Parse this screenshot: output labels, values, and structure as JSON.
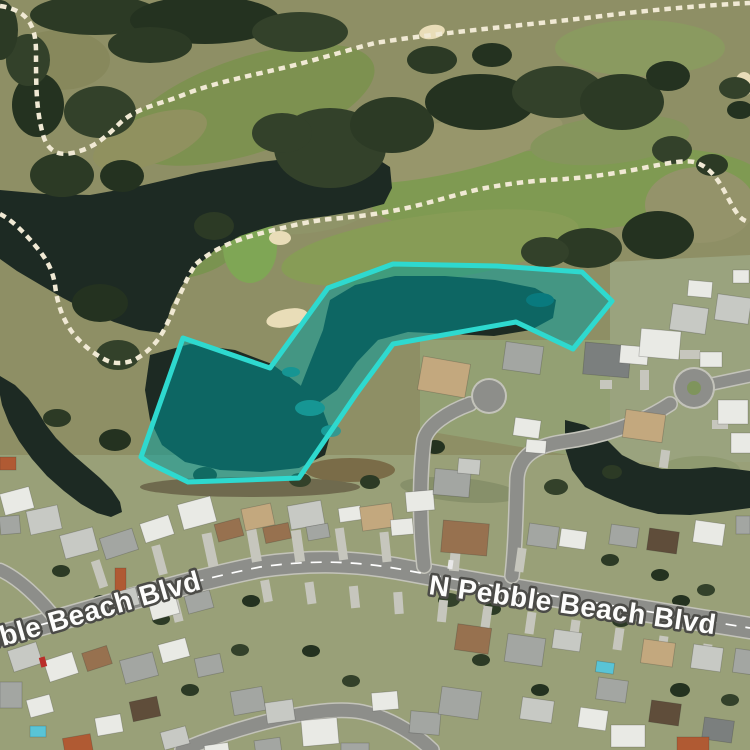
{
  "map": {
    "base_color": "#8e8f65",
    "street_labels": [
      {
        "text": "bble Beach Blvd",
        "x": -14,
        "y": 651,
        "rotation": -16,
        "size": 28
      },
      {
        "text": "N Pebble Beach Blvd",
        "x": 428,
        "y": 594,
        "rotation": 8,
        "size": 28
      }
    ],
    "overlay": {
      "points": "183,338 270,368 328,288 393,264 497,266 582,272 612,301 573,349 516,322 393,344 357,393 299,478 188,482 149,463 141,457",
      "stroke": "#2ed9cf",
      "fill": "rgba(0,158,160,0.52)",
      "stroke_width": 5
    },
    "regions": [
      {
        "pts": "0,455 750,455 750,750 0,750",
        "c": "#99a078"
      },
      {
        "pts": "610,262 750,255 750,462 610,462",
        "c": "#9aa37e"
      },
      {
        "pts": "420,340 610,340 610,462 420,430",
        "c": "#93a073"
      }
    ],
    "patches": [
      [
        250,
        105,
        130,
        48,
        -18,
        "#7d9150"
      ],
      [
        565,
        190,
        195,
        42,
        -4,
        "#7f9a52"
      ],
      [
        430,
        248,
        150,
        33,
        -8,
        "#879c56"
      ],
      [
        183,
        252,
        55,
        26,
        -10,
        "#7a9350"
      ],
      [
        640,
        48,
        85,
        28,
        0,
        "#8a9a60"
      ],
      [
        700,
        205,
        55,
        38,
        0,
        "#94936a"
      ],
      [
        95,
        240,
        65,
        28,
        -15,
        "#8b8c62"
      ],
      [
        445,
        148,
        120,
        26,
        -12,
        "#97966b"
      ],
      [
        300,
        212,
        70,
        22,
        -5,
        "#8f9468"
      ],
      [
        610,
        140,
        80,
        24,
        -6,
        "#85955c"
      ],
      [
        150,
        140,
        60,
        24,
        -20,
        "#90915f"
      ],
      [
        60,
        60,
        50,
        30,
        0,
        "#87885c"
      ],
      [
        250,
        247,
        27,
        36,
        0,
        "#7fa655"
      ],
      [
        350,
        470,
        45,
        12,
        0,
        "#7a6c48"
      ],
      [
        250,
        487,
        110,
        10,
        0,
        "#6f6a4e"
      ],
      [
        460,
        490,
        60,
        12,
        5,
        "#87906a"
      ],
      [
        700,
        470,
        40,
        14,
        0,
        "#8f9a70"
      ]
    ],
    "bunker_color": "#e9ddb8",
    "bunkers": [
      [
        287,
        318,
        21,
        9,
        -12
      ],
      [
        280,
        238,
        11,
        7,
        0
      ],
      [
        744,
        84,
        9,
        12,
        0
      ],
      [
        432,
        32,
        13,
        7,
        -10
      ]
    ],
    "pond_color": "#1d2a23",
    "ponds": [
      {
        "pts": "0,190 45,194 90,195 140,186 200,172 260,162 320,155 365,151 390,167 392,188 384,204 358,211 328,216 298,220 268,227 240,236 215,250 196,267 181,287 171,307 166,324 161,333 139,330 114,322 88,311 63,298 39,284 17,271 0,259"
      },
      {
        "pts": "0,376 15,385 28,398 38,412 46,425 56,438 70,452 85,465 100,478 112,490 120,502 122,512 111,517 97,513 81,504 64,491 47,476 32,459 19,441 9,423 2,405 0,395"
      },
      {
        "pts": "150,355 190,344 235,350 272,364 300,385 322,408 331,432 325,455 299,468 262,472 220,470 185,462 162,445 150,420 145,390"
      },
      {
        "pts": "330,300 355,285 395,276 445,276 495,280 535,288 556,300 553,318 531,330 494,336 450,334 408,332 378,340 357,362 337,390 317,404 300,388 311,360 323,330 327,312"
      },
      {
        "pts": "565,420 585,425 605,438 622,455 640,464 662,469 690,469 715,467 735,469 750,471 750,508 720,512 690,515 658,514 630,507 605,497 585,487 572,470 565,448"
      }
    ],
    "shallows": [
      [
        310,
        408,
        15,
        8,
        "#2f8f88"
      ],
      [
        331,
        431,
        10,
        6,
        "#35978f"
      ],
      [
        291,
        372,
        9,
        5,
        "#2e8c86"
      ],
      [
        540,
        300,
        14,
        7,
        "#14555a"
      ]
    ],
    "tree_colors": [
      "#2c3a25",
      "#243220",
      "#33412a"
    ],
    "trees": [
      [
        95,
        15,
        65,
        20
      ],
      [
        205,
        20,
        75,
        24
      ],
      [
        300,
        32,
        48,
        20
      ],
      [
        150,
        45,
        42,
        18
      ],
      [
        38,
        105,
        26,
        32
      ],
      [
        100,
        112,
        36,
        26
      ],
      [
        62,
        175,
        32,
        22
      ],
      [
        122,
        176,
        22,
        16
      ],
      [
        330,
        148,
        56,
        40
      ],
      [
        392,
        125,
        42,
        28
      ],
      [
        480,
        102,
        55,
        28
      ],
      [
        558,
        92,
        46,
        26
      ],
      [
        622,
        102,
        42,
        28
      ],
      [
        668,
        76,
        22,
        15
      ],
      [
        735,
        88,
        16,
        11
      ],
      [
        588,
        248,
        34,
        20
      ],
      [
        658,
        235,
        36,
        24
      ],
      [
        545,
        252,
        24,
        15
      ],
      [
        214,
        226,
        20,
        14
      ],
      [
        100,
        303,
        28,
        19
      ],
      [
        118,
        355,
        22,
        15
      ],
      [
        57,
        418,
        14,
        9
      ],
      [
        115,
        440,
        16,
        11
      ],
      [
        282,
        133,
        30,
        20
      ],
      [
        432,
        60,
        25,
        14
      ],
      [
        492,
        55,
        20,
        12
      ],
      [
        672,
        150,
        20,
        14
      ],
      [
        712,
        165,
        16,
        11
      ],
      [
        740,
        110,
        13,
        9
      ],
      [
        28,
        60,
        22,
        26
      ],
      [
        0,
        30,
        18,
        30
      ],
      [
        205,
        475,
        12,
        8
      ],
      [
        300,
        480,
        11,
        7
      ],
      [
        370,
        482,
        10,
        7
      ],
      [
        435,
        447,
        10,
        7
      ],
      [
        556,
        487,
        12,
        8
      ],
      [
        612,
        472,
        10,
        7
      ],
      [
        409,
        568,
        9,
        6
      ],
      [
        449,
        600,
        11,
        7
      ],
      [
        492,
        609,
        9,
        6
      ],
      [
        251,
        601,
        9,
        6
      ],
      [
        211,
        576,
        9,
        6
      ],
      [
        161,
        619,
        9,
        6
      ],
      [
        101,
        601,
        9,
        6
      ],
      [
        531,
        651,
        11,
        7
      ],
      [
        621,
        621,
        9,
        6
      ],
      [
        681,
        601,
        9,
        6
      ],
      [
        581,
        601,
        9,
        6
      ],
      [
        61,
        571,
        9,
        6
      ],
      [
        311,
        651,
        9,
        6
      ],
      [
        351,
        681,
        9,
        6
      ],
      [
        481,
        660,
        9,
        6
      ],
      [
        540,
        690,
        9,
        6
      ],
      [
        240,
        650,
        9,
        6
      ],
      [
        190,
        690,
        9,
        6
      ],
      [
        680,
        690,
        10,
        7
      ],
      [
        730,
        700,
        9,
        6
      ],
      [
        610,
        560,
        9,
        6
      ],
      [
        660,
        575,
        9,
        6
      ],
      [
        706,
        590,
        9,
        6
      ]
    ],
    "roads": {
      "casing": "#c3c3ba",
      "asphalt": "#8d8e8a",
      "lane_color": "#ffffff",
      "lane_dash": "11 9",
      "boulevard": {
        "d": "M0,636 C80,615 170,585 260,567 C310,560 355,560 410,571 C480,584 600,604 750,628",
        "w": 20
      },
      "streets": [
        {
          "d": "M424,566 C420,530 419,480 424,440 C428,425 448,412 470,404",
          "w": 13
        },
        {
          "d": "M512,576 C515,550 516,515 517,478 C519,456 535,446 562,442 C600,437 640,424 670,404",
          "w": 13
        },
        {
          "d": "M58,622 C40,598 18,578 0,570",
          "w": 12
        },
        {
          "d": "M182,750 C240,726 320,704 362,712 C392,718 420,738 432,750",
          "w": 13
        },
        {
          "d": "M712,384 L750,376",
          "w": 11
        }
      ],
      "bulbs": [
        [
          489,
          396,
          16
        ],
        [
          694,
          388,
          19
        ]
      ],
      "island": {
        "cx": 694,
        "cy": 388,
        "r": 7,
        "c": "#7f945c"
      }
    },
    "driveway_color": "#c6c6bd",
    "driveways": [
      [
        205,
        533,
        10,
        34,
        -12
      ],
      [
        249,
        528,
        10,
        34,
        -10
      ],
      [
        293,
        530,
        10,
        32,
        -8
      ],
      [
        337,
        528,
        9,
        32,
        -8
      ],
      [
        381,
        532,
        9,
        30,
        -6
      ],
      [
        155,
        545,
        9,
        30,
        -15
      ],
      [
        95,
        560,
        9,
        28,
        -18
      ],
      [
        450,
        545,
        10,
        26,
        5
      ],
      [
        516,
        548,
        9,
        24,
        8
      ],
      [
        172,
        600,
        9,
        22,
        -14
      ],
      [
        262,
        580,
        9,
        22,
        -10
      ],
      [
        306,
        582,
        9,
        22,
        -8
      ],
      [
        350,
        586,
        9,
        22,
        -6
      ],
      [
        394,
        592,
        9,
        22,
        -4
      ],
      [
        438,
        600,
        9,
        22,
        6
      ],
      [
        482,
        606,
        9,
        22,
        8
      ],
      [
        526,
        612,
        9,
        22,
        8
      ],
      [
        570,
        620,
        9,
        22,
        8
      ],
      [
        614,
        628,
        9,
        22,
        8
      ],
      [
        658,
        636,
        9,
        22,
        8
      ],
      [
        702,
        644,
        9,
        22,
        8
      ],
      [
        680,
        350,
        20,
        9,
        0
      ],
      [
        640,
        370,
        9,
        20,
        0
      ],
      [
        712,
        420,
        16,
        9,
        0
      ],
      [
        660,
        450,
        9,
        18,
        8
      ],
      [
        600,
        380,
        12,
        9,
        0
      ]
    ],
    "house_palette": [
      "#e9eae5",
      "#c7c9c4",
      "#a3a6a2",
      "#7b7f7e",
      "#c3a87e",
      "#97714f",
      "#b05a33",
      "#5f4d3a",
      "#59c4d6"
    ],
    "houses": [
      [
        2,
        490,
        30,
        22,
        -15,
        0
      ],
      [
        28,
        508,
        32,
        24,
        -12,
        1
      ],
      [
        0,
        457,
        16,
        13,
        0,
        6
      ],
      [
        0,
        516,
        20,
        18,
        -5,
        2
      ],
      [
        62,
        531,
        34,
        24,
        -15,
        1
      ],
      [
        102,
        533,
        34,
        22,
        -18,
        2
      ],
      [
        142,
        519,
        30,
        20,
        -18,
        0
      ],
      [
        180,
        500,
        34,
        26,
        -15,
        0
      ],
      [
        216,
        521,
        26,
        18,
        -15,
        5
      ],
      [
        243,
        506,
        30,
        22,
        -12,
        4
      ],
      [
        264,
        525,
        26,
        16,
        -12,
        5
      ],
      [
        289,
        503,
        34,
        24,
        -10,
        1
      ],
      [
        307,
        525,
        22,
        14,
        -10,
        2
      ],
      [
        339,
        507,
        22,
        14,
        -8,
        0
      ],
      [
        361,
        505,
        32,
        24,
        -8,
        4
      ],
      [
        391,
        519,
        22,
        16,
        -5,
        0
      ],
      [
        406,
        491,
        28,
        20,
        -5,
        0
      ],
      [
        434,
        470,
        36,
        26,
        5,
        2
      ],
      [
        458,
        459,
        22,
        15,
        5,
        1
      ],
      [
        442,
        522,
        46,
        32,
        5,
        5
      ],
      [
        528,
        525,
        30,
        22,
        8,
        2
      ],
      [
        560,
        530,
        26,
        18,
        8,
        0
      ],
      [
        514,
        419,
        26,
        18,
        8,
        0
      ],
      [
        526,
        440,
        20,
        13,
        5,
        0
      ],
      [
        420,
        360,
        48,
        34,
        10,
        4
      ],
      [
        504,
        344,
        38,
        28,
        8,
        2
      ],
      [
        584,
        344,
        46,
        32,
        5,
        3
      ],
      [
        620,
        346,
        28,
        18,
        5,
        0
      ],
      [
        624,
        412,
        40,
        28,
        8,
        4
      ],
      [
        718,
        400,
        30,
        24,
        0,
        0
      ],
      [
        731,
        433,
        26,
        20,
        0,
        0
      ],
      [
        640,
        330,
        40,
        28,
        5,
        0
      ],
      [
        671,
        306,
        36,
        26,
        8,
        1
      ],
      [
        716,
        296,
        34,
        26,
        8,
        1
      ],
      [
        688,
        281,
        24,
        16,
        5,
        0
      ],
      [
        733,
        270,
        16,
        13,
        0,
        0
      ],
      [
        700,
        352,
        22,
        15,
        0,
        0
      ],
      [
        610,
        526,
        28,
        20,
        8,
        2
      ],
      [
        648,
        530,
        30,
        22,
        8,
        7
      ],
      [
        694,
        522,
        30,
        22,
        8,
        0
      ],
      [
        736,
        516,
        14,
        18,
        0,
        2
      ],
      [
        10,
        646,
        30,
        22,
        -18,
        1
      ],
      [
        46,
        656,
        30,
        22,
        -18,
        0
      ],
      [
        84,
        649,
        26,
        19,
        -18,
        5
      ],
      [
        122,
        656,
        34,
        24,
        -15,
        2
      ],
      [
        160,
        641,
        28,
        19,
        -15,
        0
      ],
      [
        196,
        656,
        26,
        19,
        -12,
        2
      ],
      [
        115,
        568,
        11,
        24,
        0,
        6
      ],
      [
        112,
        590,
        26,
        18,
        -15,
        1
      ],
      [
        150,
        599,
        28,
        18,
        -15,
        0
      ],
      [
        186,
        593,
        26,
        18,
        -15,
        2
      ],
      [
        232,
        689,
        32,
        24,
        -10,
        2
      ],
      [
        266,
        701,
        28,
        21,
        -8,
        1
      ],
      [
        302,
        719,
        36,
        26,
        -5,
        0
      ],
      [
        341,
        743,
        28,
        18,
        0,
        2
      ],
      [
        372,
        692,
        26,
        18,
        -5,
        0
      ],
      [
        410,
        712,
        30,
        22,
        5,
        2
      ],
      [
        0,
        682,
        22,
        26,
        0,
        2
      ],
      [
        28,
        697,
        24,
        18,
        -15,
        0
      ],
      [
        30,
        726,
        16,
        11,
        0,
        8
      ],
      [
        64,
        736,
        28,
        20,
        -10,
        6
      ],
      [
        96,
        716,
        26,
        18,
        -10,
        0
      ],
      [
        131,
        699,
        28,
        20,
        -12,
        7
      ],
      [
        162,
        729,
        26,
        18,
        -15,
        1
      ],
      [
        205,
        744,
        24,
        14,
        -8,
        0
      ],
      [
        255,
        739,
        26,
        16,
        -8,
        2
      ],
      [
        456,
        626,
        34,
        26,
        8,
        5
      ],
      [
        506,
        636,
        38,
        28,
        8,
        2
      ],
      [
        553,
        631,
        28,
        19,
        8,
        1
      ],
      [
        597,
        679,
        30,
        22,
        8,
        2
      ],
      [
        642,
        641,
        32,
        24,
        8,
        4
      ],
      [
        692,
        646,
        30,
        24,
        8,
        1
      ],
      [
        734,
        650,
        26,
        24,
        8,
        2
      ],
      [
        440,
        689,
        40,
        28,
        8,
        2
      ],
      [
        521,
        699,
        32,
        22,
        8,
        1
      ],
      [
        579,
        709,
        28,
        20,
        8,
        0
      ],
      [
        650,
        702,
        30,
        22,
        8,
        7
      ],
      [
        703,
        719,
        30,
        22,
        8,
        3
      ],
      [
        596,
        662,
        18,
        11,
        8,
        8
      ],
      [
        611,
        725,
        34,
        22,
        0,
        0
      ],
      [
        677,
        737,
        32,
        16,
        0,
        6
      ]
    ],
    "cars": [
      [
        40,
        657,
        6,
        10,
        -15,
        "#b92e2a"
      ],
      [
        448,
        560,
        5,
        9,
        8,
        "#e8e8e8"
      ]
    ],
    "cart_paths": {
      "color": "#f0e9d4",
      "width": 4.5,
      "dash": "6.5 5",
      "segments": [
        "M0,6 C28,10 36,26 36,52 C36,86 36,112 44,138 C49,151 58,156 72,153 C92,149 104,139 120,123 C138,107 158,105 183,95 C215,82 255,75 295,65 C330,56 355,48 375,43 C450,31 540,24 610,15 C660,9 710,5 750,3",
        "M196,264 C215,248 235,240 262,233 C290,226 310,221 330,219 C355,217 370,215 392,211 C420,206 450,196 480,189 C510,183 540,180 565,179 C590,177 620,173 648,167 C668,163 685,160 694,162 C706,165 715,175 722,187 C728,197 733,209 740,217 C744,221 748,222 750,222",
        "M0,214 C12,220 25,233 38,249 C48,261 53,272 55,285 C57,302 62,318 72,332 C82,345 95,355 108,361 C116,364 126,364 136,359 C148,352 158,342 165,328 C172,314 177,300 183,288 C187,279 191,271 196,264"
      ]
    }
  }
}
